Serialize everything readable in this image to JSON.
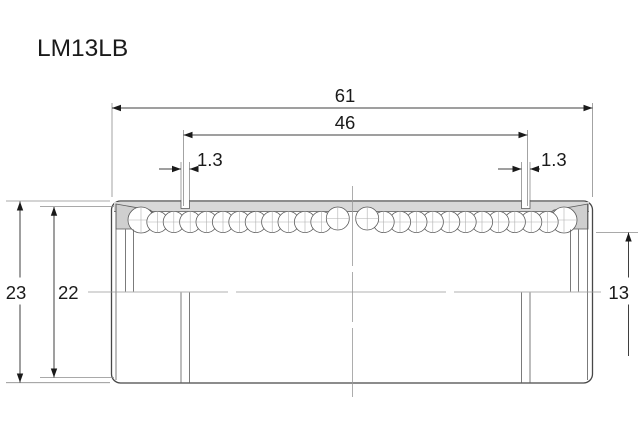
{
  "drawing": {
    "title": "LM13LB"
  },
  "dimensions": {
    "overall_length": "61",
    "retaining_groove_span": "46",
    "groove_width_left": "1.3",
    "groove_width_right": "1.3",
    "outer_diameter": "23",
    "seal_outer_diameter": "22",
    "bore_diameter": "13"
  },
  "colors": {
    "background": "#ffffff",
    "line": "#3f3f3f",
    "thin_line": "#8c8c8c",
    "shell_fill": "#d8d8d8",
    "seal_fill": "#cfcfcf",
    "text": "#1a1a1a"
  }
}
